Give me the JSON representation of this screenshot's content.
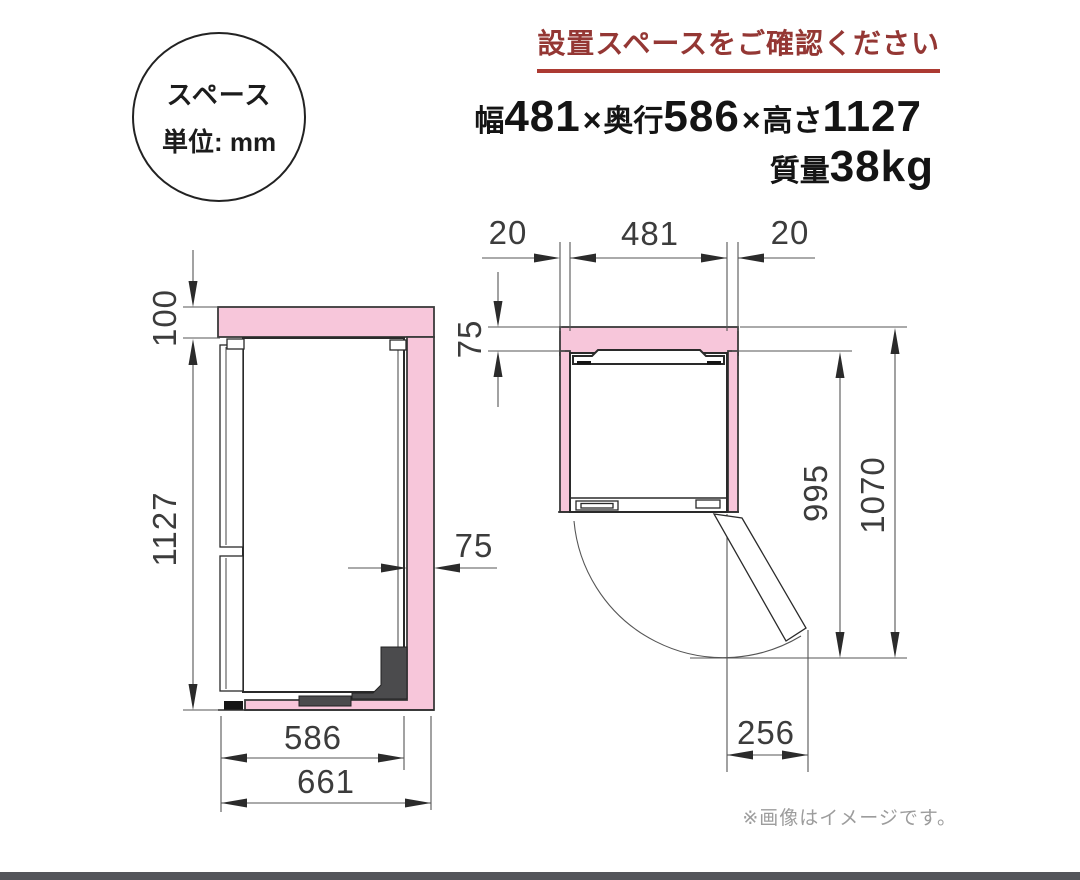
{
  "header": {
    "notice": "設置スペースをご確認ください",
    "badge": {
      "line1": "スペース",
      "line2": "単位: mm"
    },
    "spec_parts": [
      [
        "幅",
        "l"
      ],
      [
        "481",
        "n"
      ],
      [
        "×",
        "x"
      ],
      [
        "奥行",
        "l"
      ],
      [
        "586",
        "n"
      ],
      [
        "×",
        "x"
      ],
      [
        "高さ",
        "l"
      ],
      [
        "1127",
        "n"
      ]
    ],
    "weight_parts": [
      [
        "質量",
        "l"
      ],
      [
        "38kg",
        "n"
      ]
    ]
  },
  "side_view": {
    "top_clearance": "100",
    "height": "1127",
    "back_clearance": "75",
    "depth": "586",
    "total_depth": "661"
  },
  "top_view": {
    "left_clearance": "20",
    "width": "481",
    "right_clearance": "20",
    "back_clearance": "75",
    "open_depth": "995",
    "total_open_depth": "1070",
    "door_swing": "256"
  },
  "footer": {
    "note": "※画像はイメージです。"
  },
  "colors": {
    "clearance_pink": "#F7C6DA",
    "accent_red": "#943734",
    "underline_red": "#AC3A32",
    "note_gray": "#9C9C9C"
  }
}
